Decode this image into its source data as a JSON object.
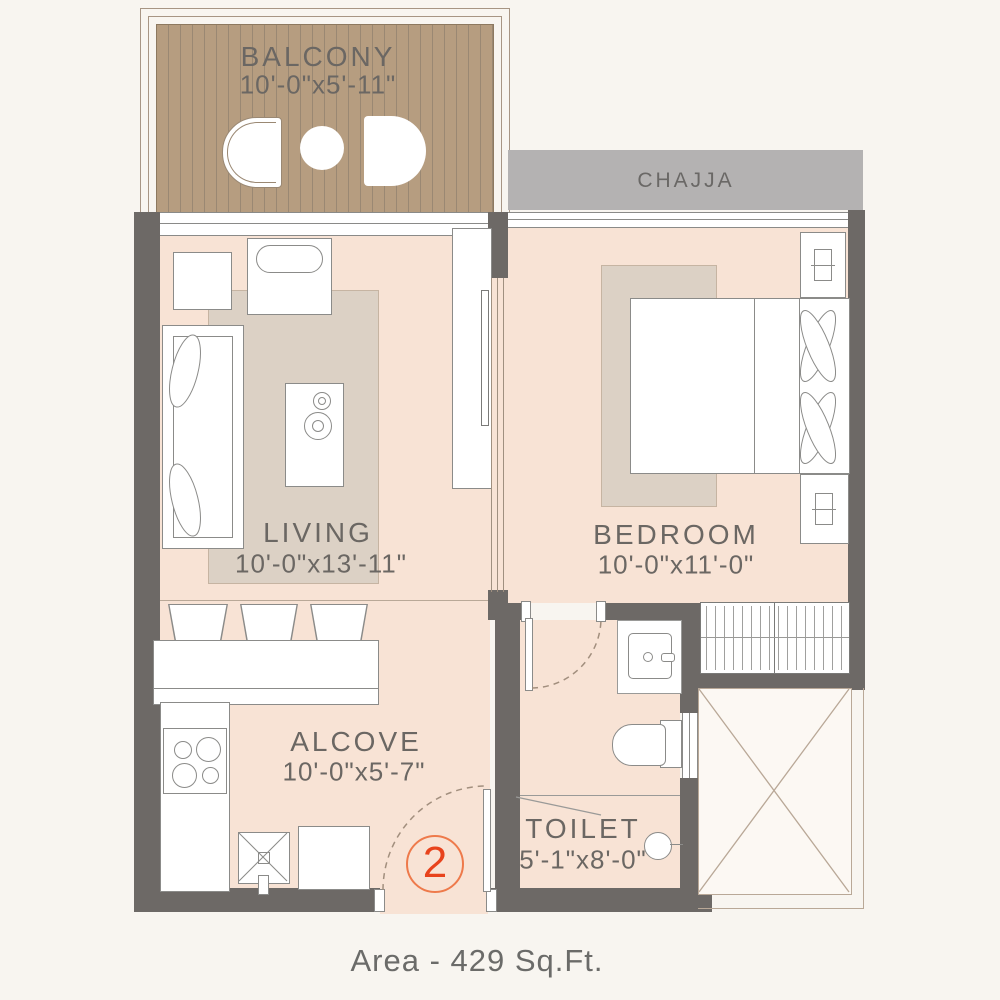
{
  "plan": {
    "area_label": "Area - 429 Sq.Ft.",
    "unit_number": "2",
    "rooms": {
      "balcony": {
        "name": "BALCONY",
        "dims": "10'-0\"x5'-11\""
      },
      "chajja": {
        "name": "CHAJJA"
      },
      "living": {
        "name": "LIVING",
        "dims": "10'-0\"x13'-11\""
      },
      "bedroom": {
        "name": "BEDROOM",
        "dims": "10'-0\"x11'-0\""
      },
      "alcove": {
        "name": "ALCOVE",
        "dims": "10'-0\"x5'-7\""
      },
      "toilet": {
        "name": "TOILET",
        "dims": "5'-1\"x8'-0\""
      }
    },
    "colors": {
      "background": "#f8f5f0",
      "floor": "#f8e3d5",
      "wall": "#6d6966",
      "wood": "#b69d80",
      "chajja": "#b4b2b2",
      "rug": "#dcd1c5",
      "label_text": "#6b6763",
      "accent": "#e8431c"
    }
  }
}
